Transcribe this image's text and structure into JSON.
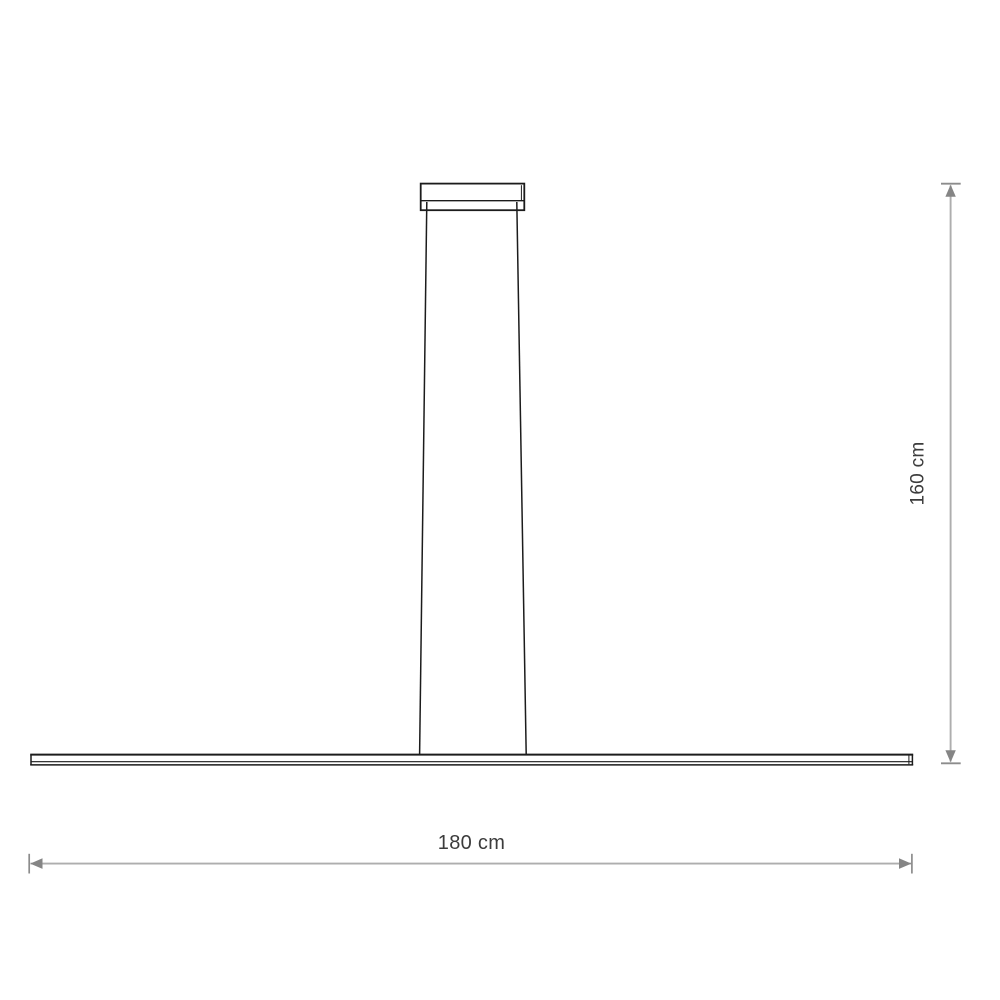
{
  "dimensions": {
    "height": {
      "label": "160 cm"
    },
    "width": {
      "label": "180 cm"
    }
  },
  "colors": {
    "background": "#ffffff",
    "outline": "#1c1c1c",
    "dimension_line": "#aeaeae",
    "dimension_tick": "#8c8c8c",
    "dimension_arrow": "#858585",
    "label_text": "#3c3c3c"
  }
}
